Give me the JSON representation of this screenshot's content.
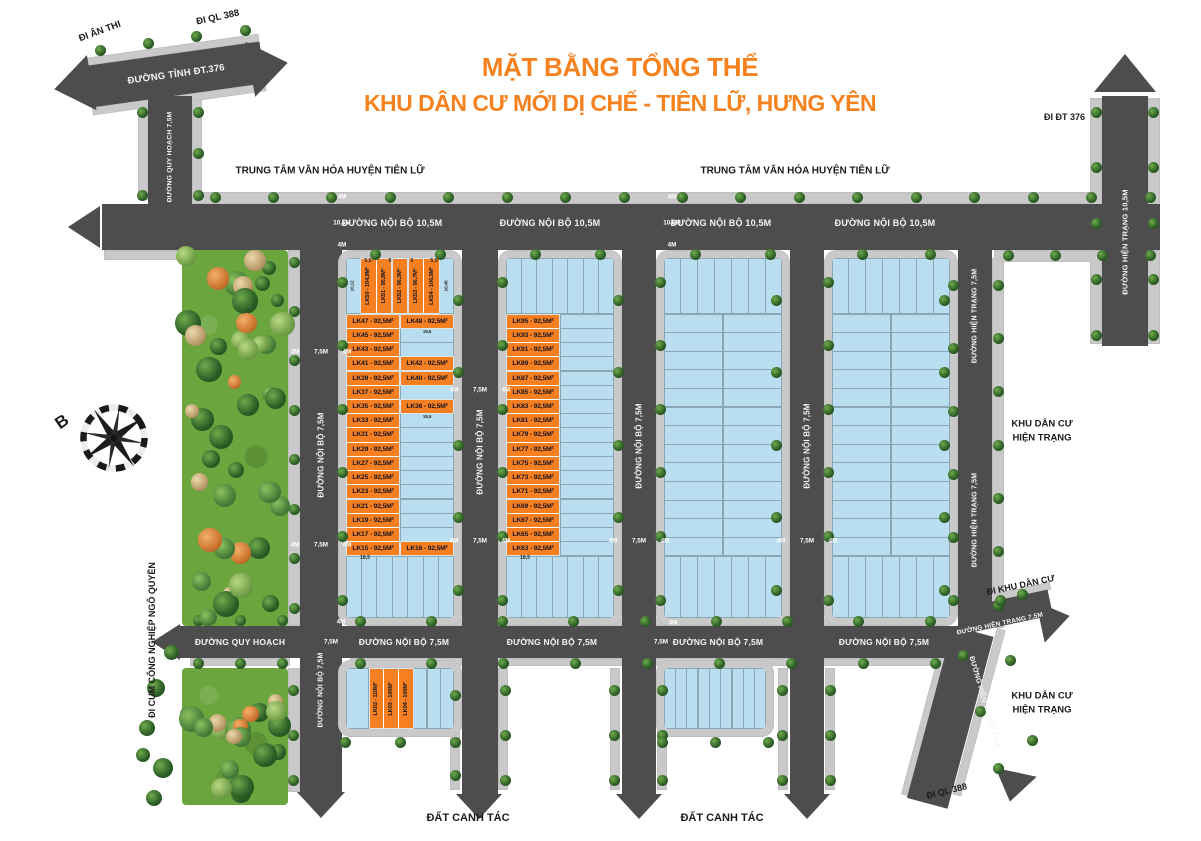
{
  "title": {
    "line1": "MẶT BẰNG TỔNG THỂ",
    "line2": "KHU DÂN CƯ MỚI DỊ CHẾ - TIÊN LỮ, HƯNG YÊN"
  },
  "landmarks": {
    "cultural_center": "TRUNG TÂM VĂN HÓA HUYỆN TIÊN LỮ",
    "existing_area_line1": "KHU DÂN CƯ",
    "existing_area_line2": "HIỆN TRẠNG",
    "farmland": "ĐẤT CANH TÁC",
    "compass_north": "B"
  },
  "roads": {
    "dt376": "ĐƯỜNG TỈNH ĐT.376",
    "internal_105": "ĐƯỜNG NỘI BỘ 10,5M",
    "internal_75": "ĐƯỜNG NỘI BỘ 7,5M",
    "planned": "ĐƯỜNG QUY HOẠCH",
    "planned_75": "ĐƯỜNG QUY HOẠCH 7,5M",
    "existing_75": "ĐƯỜNG HIỆN TRẠNG 7,5M",
    "existing_105": "ĐƯỜNG HIỆN TRẠNG 10,5M"
  },
  "directions": {
    "an_thi": "ĐI ÂN THI",
    "ql388_top": "ĐI QL 388",
    "dt376": "ĐI ĐT 376",
    "residential": "ĐI KHU DÂN CƯ",
    "ql388_bottom": "ĐI QL 388",
    "ngo_quyen": "ĐI CỤM CÔNG NGHIỆP NGÔ QUYỀN"
  },
  "dims": {
    "w4": "4M",
    "w75": "7,5M",
    "w105": "10,5M",
    "d185": "18,5",
    "d1012": "10,12",
    "d1048": "10,48",
    "t55": "5,5",
    "t5": "5"
  },
  "lots": {
    "top_row": [
      "LK50 - 104,9M²",
      "LK51 - 95,8M²",
      "LK52 - 96,3M²",
      "LK53 - 96,7M²",
      "LK54 - 106,9M²"
    ],
    "block_a_rows": [
      {
        "l": "LK47 - 92,5M²",
        "r": "LK48 - 92,5M²"
      },
      {
        "l": "LK45 - 92,5M²",
        "r": ""
      },
      {
        "l": "LK43 - 92,5M²",
        "r": ""
      },
      {
        "l": "LK41 - 92,5M²",
        "r": "LK42 - 92,5M²"
      },
      {
        "l": "LK39 - 92,5M²",
        "r": "LK40 - 92,5M²"
      },
      {
        "l": "LK37 - 92,5M²",
        "r": ""
      },
      {
        "l": "LK35 - 92,5M²",
        "r": "LK36 - 92,5M²"
      },
      {
        "l": "LK33 - 92,5M²",
        "r": ""
      },
      {
        "l": "LK31 - 92,5M²",
        "r": ""
      },
      {
        "l": "LK29 - 92,5M²",
        "r": ""
      },
      {
        "l": "LK27 - 92,5M²",
        "r": ""
      },
      {
        "l": "LK25 - 92,5M²",
        "r": ""
      },
      {
        "l": "LK23 - 92,5M²",
        "r": ""
      },
      {
        "l": "LK21 - 92,5M²",
        "r": ""
      },
      {
        "l": "LK19 - 92,5M²",
        "r": ""
      },
      {
        "l": "LK17 - 92,5M²",
        "r": ""
      },
      {
        "l": "LK15 - 92,5M²",
        "r": "LK16 - 92,5M²"
      }
    ],
    "block_b_rows": [
      "LK95 - 92,5M²",
      "LK93 - 92,5M²",
      "LK91 - 92,5M²",
      "LK89 - 92,5M²",
      "LK87 - 92,5M²",
      "LK85 - 92,5M²",
      "LK83 - 92,5M²",
      "LK81 - 92,5M²",
      "LK79 - 92,5M²",
      "LK77 - 92,5M²",
      "LK75 - 92,5M²",
      "LK73 - 92,5M²",
      "LK71 - 92,5M²",
      "LK69 - 92,5M²",
      "LK67 - 92,5M²",
      "LK65 - 92,5M²",
      "LK63 - 92,5M²"
    ],
    "block_e": [
      "LK02 - 110M²",
      "LK03 - 100M²",
      "LK04 - 100M²"
    ]
  },
  "colors": {
    "accent_orange": "#F5821F",
    "lot_orange": "#F57F21",
    "lot_blue": "#B9DEF0",
    "road_dark": "#4D4D4D",
    "sidewalk_gray": "#C9C9C9",
    "park_green": "#6BA53E"
  }
}
